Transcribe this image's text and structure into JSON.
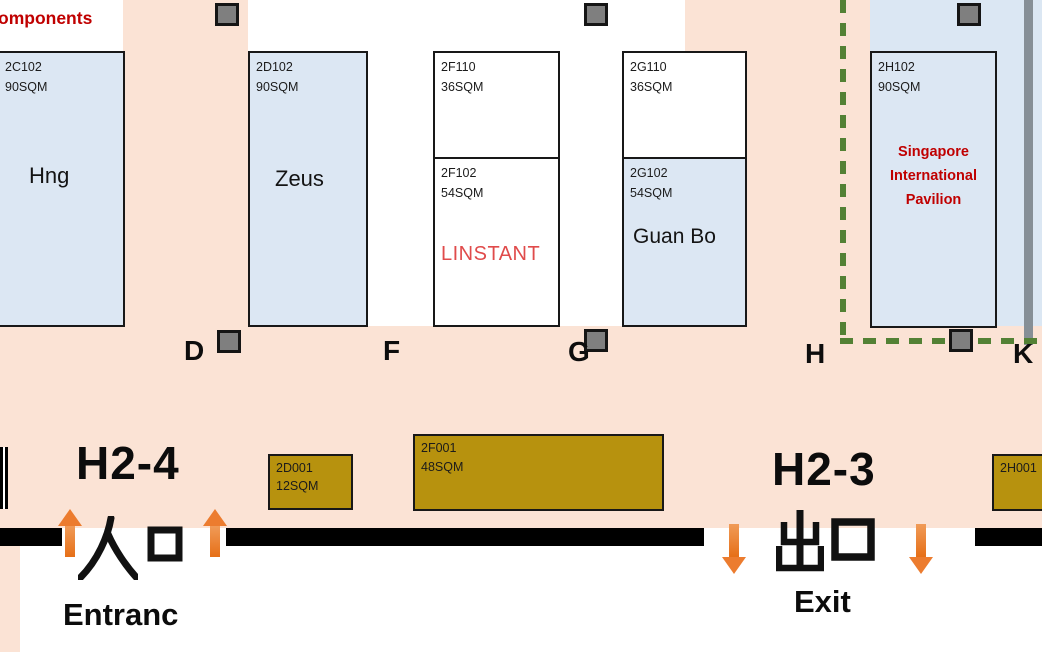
{
  "top_left_label": "omponents",
  "colors": {
    "peach_floor": "#fbe3d5",
    "booth_blue": "#dce7f3",
    "booth_gold": "#b7920e",
    "pavilion_red": "#c00000",
    "brand_red": "#e04b4b",
    "dashed_green": "#538135",
    "pillar_gray": "#7f7f7f",
    "arrow_orange": "#ec7c2f",
    "wall_black": "#000000"
  },
  "grid_letters": {
    "d": "D",
    "f": "F",
    "g": "G",
    "h": "H",
    "k": "K"
  },
  "halls": {
    "left": "H2-4",
    "right": "H2-3"
  },
  "entrance": {
    "cn": "入口",
    "en": "Entranc"
  },
  "exit": {
    "cn": "出口",
    "en": "Exit"
  },
  "pavilion": {
    "l1": "Singapore",
    "l2": "International",
    "l3": "Pavilion"
  },
  "booths": {
    "b2c102": {
      "code": "2C102",
      "area": "90SQM",
      "company": "Hng"
    },
    "b2d102": {
      "code": "2D102",
      "area": "90SQM",
      "company": "Zeus"
    },
    "b2f110": {
      "code": "2F110",
      "area": "36SQM"
    },
    "b2f102": {
      "code": "2F102",
      "area": "54SQM",
      "company": "LINSTANT"
    },
    "b2g110": {
      "code": "2G110",
      "area": "36SQM"
    },
    "b2g102": {
      "code": "2G102",
      "area": "54SQM",
      "company": "Guan Bo"
    },
    "b2h102": {
      "code": "2H102",
      "area": "90SQM",
      "company": "Singapore International Pavilion"
    },
    "b2d001": {
      "code": "2D001",
      "area": "12SQM"
    },
    "b2f001": {
      "code": "2F001",
      "area": "48SQM"
    },
    "b2h001": {
      "code": "2H001"
    }
  }
}
